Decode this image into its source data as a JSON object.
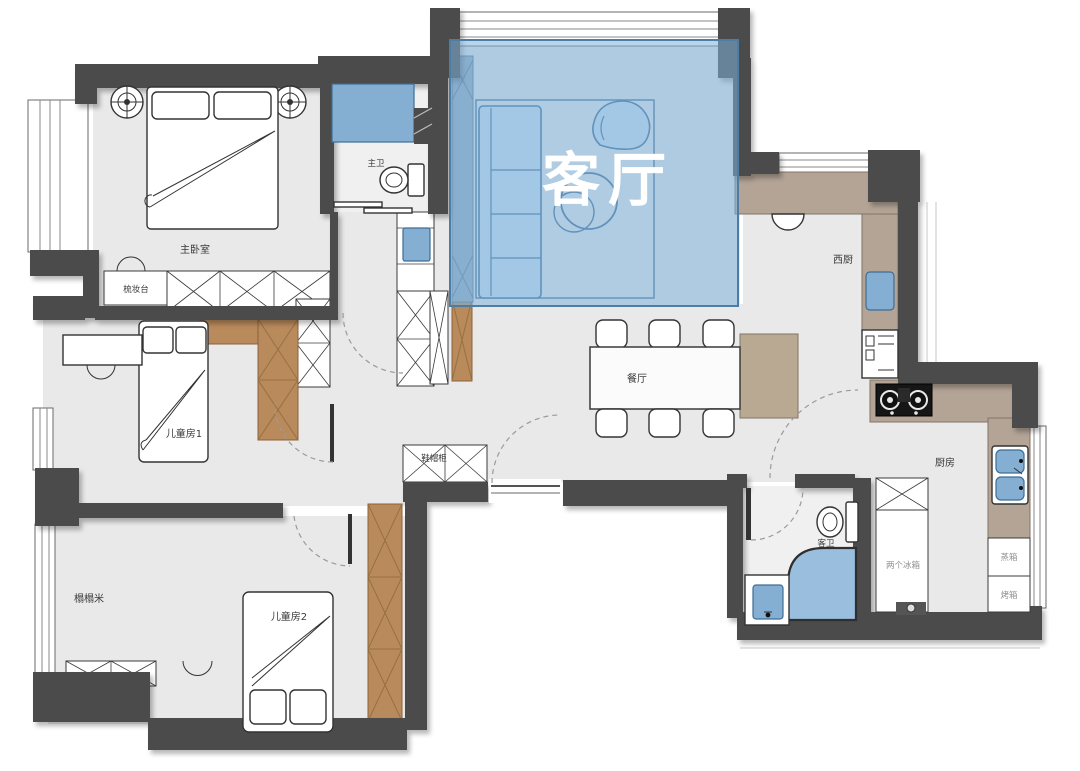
{
  "plan": {
    "type": "apartment-floor-plan",
    "language": "zh-CN",
    "highlight": {
      "room": "客厅",
      "overlay_color": "#7fb2dc",
      "label_color": "#ffffff"
    }
  },
  "rooms": [
    {
      "id": "living-room",
      "label": "客厅",
      "highlighted": true
    },
    {
      "id": "master-bedroom",
      "label": "主卧室",
      "highlighted": false
    },
    {
      "id": "master-bathroom",
      "label": "主卫",
      "highlighted": false
    },
    {
      "id": "dining-room",
      "label": "餐厅",
      "highlighted": false
    },
    {
      "id": "west-kitchen",
      "label": "西厨",
      "highlighted": false
    },
    {
      "id": "kitchen",
      "label": "厨房",
      "highlighted": false
    },
    {
      "id": "guest-bathroom",
      "label": "客卫",
      "highlighted": false
    },
    {
      "id": "kids-room-1",
      "label": "儿童房1",
      "highlighted": false
    },
    {
      "id": "kids-room-2",
      "label": "儿童房2",
      "highlighted": false
    },
    {
      "id": "tatami-room",
      "label": "榻榻米",
      "highlighted": false
    }
  ],
  "fixtures": [
    {
      "id": "dressing-table",
      "label": "梳妆台"
    },
    {
      "id": "shoe-cabinet",
      "label": "鞋帽柜"
    },
    {
      "id": "two-fridges",
      "label": "两个冰箱"
    },
    {
      "id": "steam-oven",
      "label": "蒸箱"
    },
    {
      "id": "oven",
      "label": "烤箱"
    }
  ],
  "colors": {
    "wall": "#4b4b4b",
    "floor": "#e9e9e9",
    "highlight_overlay": "#7fb2dc",
    "wood_cabinet": "#b98a5c",
    "marble_counter": "#b3a496",
    "fixture_blue": "#85aed3",
    "furniture_outline": "#333333"
  }
}
